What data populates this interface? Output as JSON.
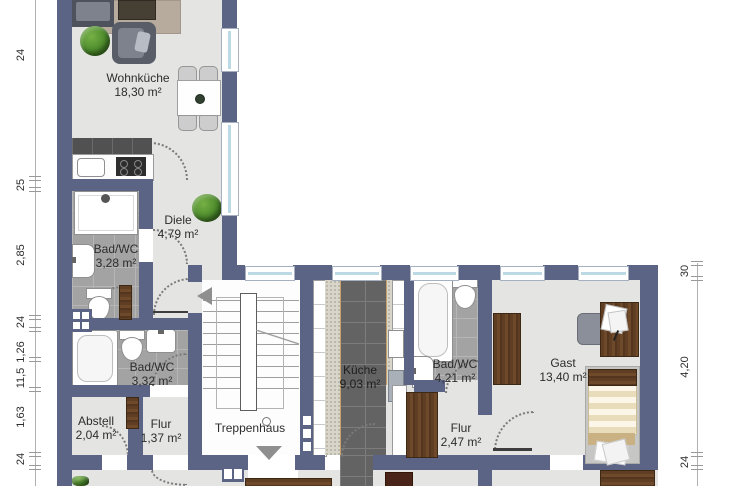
{
  "plan": {
    "type": "floorplan",
    "language": "de",
    "rooms": [
      {
        "id": "wohnkueche",
        "name": "Wohnküche",
        "area": "18,30 m²"
      },
      {
        "id": "diele",
        "name": "Diele",
        "area": "4,79 m²"
      },
      {
        "id": "bad_wc_1",
        "name": "Bad/WC",
        "area": "3,28 m²"
      },
      {
        "id": "bad_wc_2",
        "name": "Bad/WC",
        "area": "3,32 m²"
      },
      {
        "id": "abstell",
        "name": "Abstell",
        "area": "2,04 m²"
      },
      {
        "id": "flur_1",
        "name": "Flur",
        "area": "1,37 m²"
      },
      {
        "id": "treppenhaus",
        "name": "Treppenhaus",
        "area": ""
      },
      {
        "id": "kueche",
        "name": "Küche",
        "area": "9,03 m²"
      },
      {
        "id": "bad_wc_3",
        "name": "Bad/WC",
        "area": "4,21 m²"
      },
      {
        "id": "flur_2",
        "name": "Flur",
        "area": "2,47 m²"
      },
      {
        "id": "gast",
        "name": "Gast",
        "area": "13,40 m²"
      }
    ],
    "dimensions": {
      "left": [
        "24",
        "25",
        "2,85",
        "24",
        "1,26",
        "11,5",
        "1,63",
        "24"
      ],
      "right": [
        "30",
        "4,20",
        "24"
      ]
    },
    "colors": {
      "wall": "#5c6485",
      "floor": "#e4e4e2",
      "tile_light": "#a3a3a3",
      "tile_dark": "#636363",
      "window_glass": "#bcd9e4",
      "wood": "#5f3e24",
      "plant_green": "#4b8a2b"
    }
  }
}
